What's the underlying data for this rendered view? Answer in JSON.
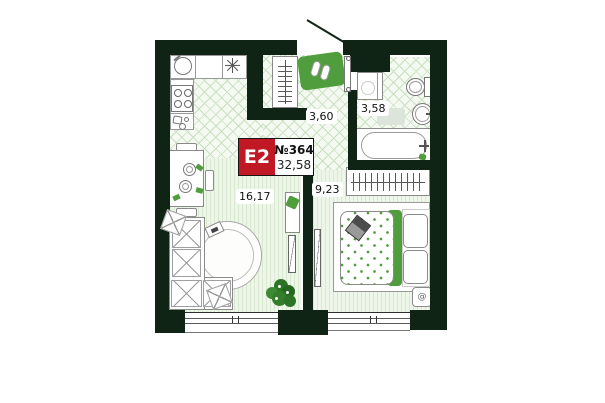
{
  "unit": {
    "type_label": "E2",
    "number": "№364",
    "total_area": "32,58"
  },
  "rooms": [
    {
      "id": "hallway",
      "area": "3,60"
    },
    {
      "id": "bathroom",
      "area": "3,58"
    },
    {
      "id": "kitchen-living-room",
      "area": "16,17"
    },
    {
      "id": "bedroom",
      "area": "9,23"
    }
  ],
  "icons": {
    "fridge_asterisk": "css-8-spoke-asterisk",
    "spiral_symbol": "@"
  },
  "colors": {
    "wall": "#102415",
    "accent_green": "#4f9d3c",
    "unit_red": "#c01825",
    "floor_line": "#c9e0c0"
  }
}
